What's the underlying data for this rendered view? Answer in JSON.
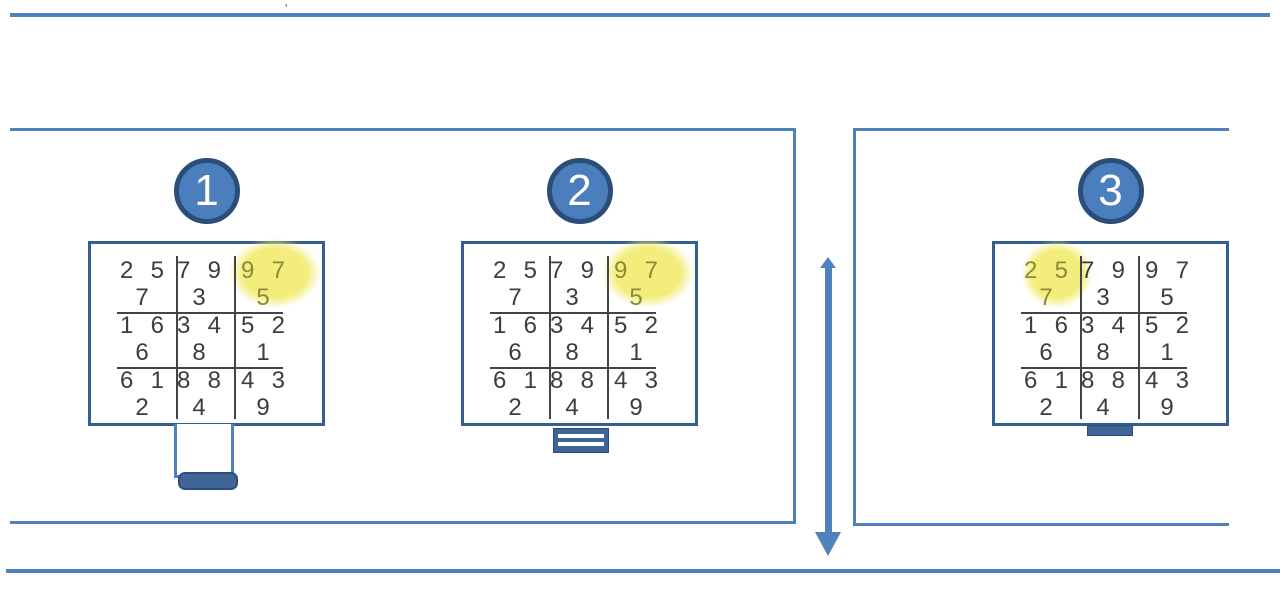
{
  "colors": {
    "line_blue": "#4f81bd",
    "grid_box_border": "#365f91",
    "badge_fill": "#4a7ebc",
    "badge_border": "#2b4d77",
    "stand_fill": "#3f6497",
    "stand_border": "#2b4d77",
    "digit": "#3d3d3d",
    "digit_highlighted": "#8a8a3a",
    "highlight_yellow": "#f3ed7c",
    "grid_line": "#444444"
  },
  "stray_mark": "'",
  "grid": {
    "rows": [
      [
        {
          "top": "2 5",
          "bottom": "7"
        },
        {
          "top": "7 9",
          "bottom": "3"
        },
        {
          "top": "9 7",
          "bottom": "5"
        }
      ],
      [
        {
          "top": "1 6",
          "bottom": "6"
        },
        {
          "top": "3 4",
          "bottom": "8"
        },
        {
          "top": "5 2",
          "bottom": "1"
        }
      ],
      [
        {
          "top": "6 1",
          "bottom": "2"
        },
        {
          "top": "8 8",
          "bottom": "4"
        },
        {
          "top": "4 3",
          "bottom": "9"
        }
      ]
    ]
  },
  "panels": [
    {
      "label": "1",
      "highlight_cell": {
        "row": 0,
        "col": 2
      },
      "highlight_position": "top-right",
      "stand": "tall-neck-plug"
    },
    {
      "label": "2",
      "highlight_cell": {
        "row": 0,
        "col": 2
      },
      "highlight_position": "top-right",
      "stand": "striped-base"
    },
    {
      "label": "3",
      "highlight_cell": {
        "row": 0,
        "col": 0
      },
      "highlight_position": "top-left",
      "stand": "small-base"
    }
  ],
  "arrow": {
    "direction": "down"
  }
}
